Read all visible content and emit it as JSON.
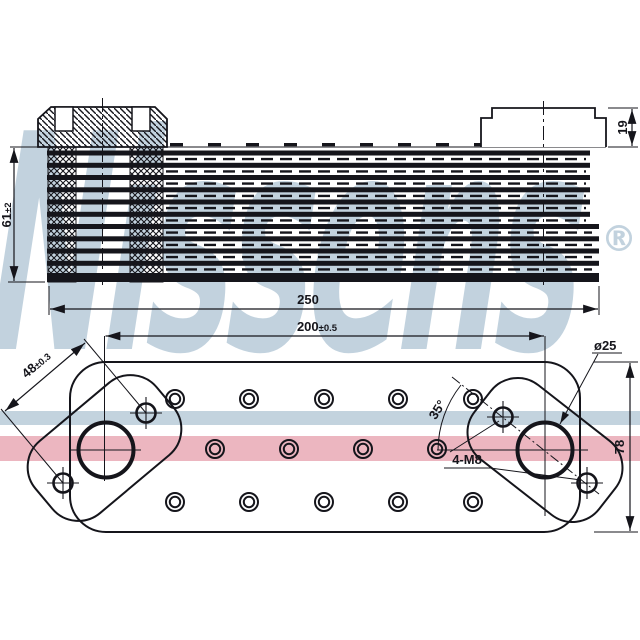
{
  "brand": {
    "watermark_text": "Nissens",
    "registered_mark": "®"
  },
  "side_view": {
    "description": "oil cooler core side section",
    "dim_height": {
      "value": "61",
      "tolerance": "±2"
    },
    "dim_length": {
      "value": "250"
    },
    "dim_connector_height": {
      "value": "19"
    }
  },
  "bottom_view": {
    "description": "oil cooler base plate with ports",
    "dim_port_spacing": {
      "value": "200",
      "tolerance": "±0.5"
    },
    "dim_bolt_spacing": {
      "value": "48",
      "tolerance": "±0.3"
    },
    "dim_port_diameter": {
      "value": "ø25"
    },
    "dim_body_width": {
      "value": "78"
    },
    "thread_callout": {
      "value": "4-M8"
    },
    "angle_callout": {
      "value": "35°"
    }
  },
  "colors": {
    "line": "#15151b",
    "band_blue": "#c3d3de",
    "band_pink": "#ecb6c0",
    "watermark": "#b3c8d7"
  }
}
